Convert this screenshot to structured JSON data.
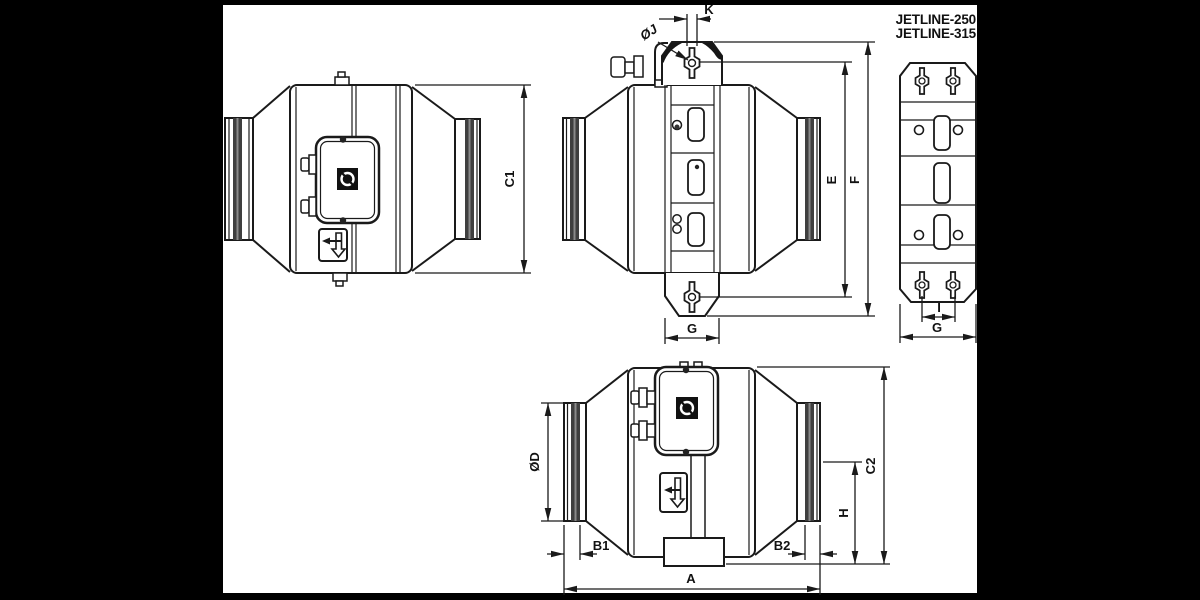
{
  "product": {
    "line1": "JETLINE-250",
    "line2": "JETLINE-315"
  },
  "dims": {
    "c1": "C1",
    "k": "K",
    "oj": "ØJ",
    "e": "E",
    "f": "F",
    "g_side": "G",
    "i": "I",
    "g_bracket": "G",
    "od": "ØD",
    "b1": "B1",
    "b2": "B2",
    "a": "A",
    "h": "H",
    "c2": "C2"
  },
  "colors": {
    "background": "#000000",
    "paper": "#ffffff",
    "line": "#1a1a1a",
    "gasket": "#3f3f3f",
    "gasket_highlight": "#8a8a8a",
    "logo_bg": "#111111"
  }
}
